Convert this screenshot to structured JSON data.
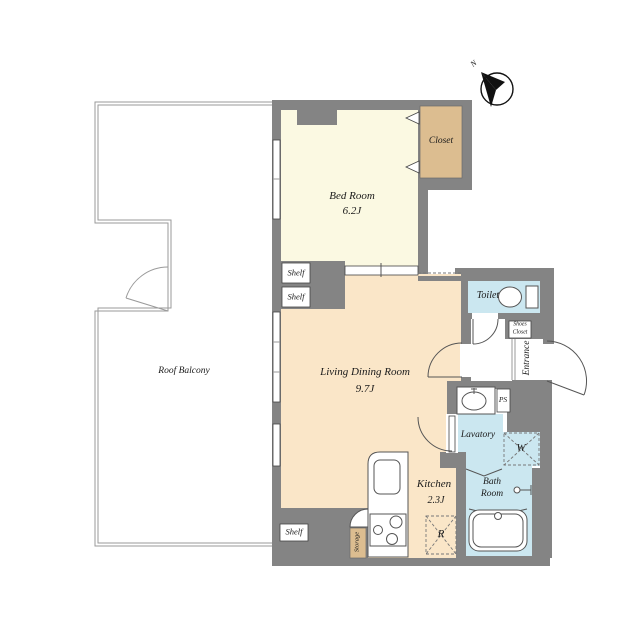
{
  "colors": {
    "wall": "#848484",
    "bedroom": "#FBF9E2",
    "living": "#FAE6C8",
    "closet": "#DCBD90",
    "wet": "#CBE7F0",
    "text": "#1a1a1a"
  },
  "compass": {
    "north_label": "N"
  },
  "rooms": {
    "bedroom": {
      "label": "Bed Room",
      "size": "6.2J"
    },
    "living": {
      "label": "Living Dining Room",
      "size": "9.7J"
    },
    "kitchen": {
      "label": "Kitchen",
      "size": "2.3J"
    },
    "balcony": {
      "label": "Roof Balcony"
    },
    "closet": {
      "label": "Closet"
    },
    "toilet": {
      "label": "Toilet"
    },
    "lavatory": {
      "label": "Lavatory"
    },
    "bath": {
      "line1": "Bath",
      "line2": "Room"
    },
    "entrance": {
      "label": "Entrance"
    },
    "shoes_closet": {
      "line1": "Shoes",
      "line2": "Closet"
    },
    "storage": {
      "label": "Storage"
    }
  },
  "fixtures": {
    "pipe_space": "PS",
    "washer": "W",
    "refrigerator": "R"
  },
  "shelves": {
    "bedroom_shelf": "Shelf",
    "living_shelf": "Shelf",
    "bottom_shelf": "Shelf"
  }
}
